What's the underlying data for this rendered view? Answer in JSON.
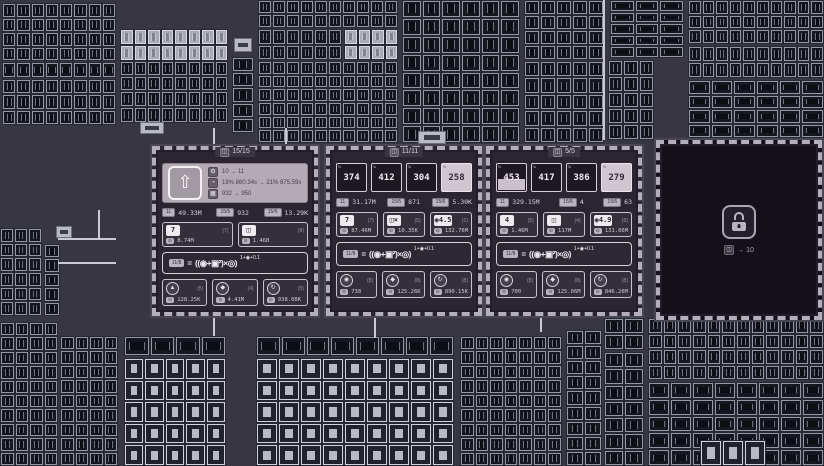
{
  "panels": [
    {
      "name": "upgrade-station",
      "header_icon": "◫",
      "header": "15/15",
      "card": {
        "arrow": "⇧",
        "rows": [
          {
            "icon": "⚙",
            "text": "10 → 11"
          },
          {
            "icon": "◔",
            "text": "19% 860.34s → 21% 875.59s"
          },
          {
            "icon": "▦",
            "text": "932 → 950"
          }
        ]
      },
      "stats": [
        {
          "badge": "11",
          "value": "49.33M"
        },
        {
          "badge": "15/5",
          "value": "932"
        },
        {
          "badge": "15/6",
          "value": "13.29K"
        }
      ],
      "slots": [
        {
          "tile": "7",
          "count": "(7)",
          "cost_icon": "⊙",
          "cost": "8.74M"
        },
        {
          "tile": "◫",
          "count": "(8)",
          "cost_icon": "⊙",
          "cost": "1.46B"
        }
      ],
      "formula": {
        "lhs": "11/8",
        "eq": "=",
        "body": "((◉+▣²)×◎)",
        "exp": "1+◉+0.1"
      },
      "actions": [
        {
          "glyph": "▲",
          "count": "(5)",
          "cost_icon": "⊙",
          "value": "128.25K"
        },
        {
          "glyph": "◆",
          "count": "(4)",
          "cost_icon": "⊙",
          "value": "4.41M"
        },
        {
          "glyph": "↻",
          "count": "(5)",
          "cost_icon": "⊙",
          "value": "938.08K"
        }
      ]
    },
    {
      "name": "station-2",
      "header_icon": "◫",
      "header": "11/11",
      "tiles": [
        {
          "corner": "↻",
          "value": "374"
        },
        {
          "corner": "↻",
          "value": "412"
        },
        {
          "corner": "↻",
          "value": "304"
        },
        {
          "corner": "↻",
          "value": "258"
        }
      ],
      "stats": [
        {
          "badge": "11",
          "value": "31.17M"
        },
        {
          "badge": "15/5",
          "value": "871"
        },
        {
          "badge": "15/6",
          "value": "5.30K"
        }
      ],
      "slots": [
        {
          "tile": "7",
          "count": "(7)",
          "cost_icon": "⊙",
          "cost": "87.46M"
        },
        {
          "tile": "◫×",
          "count": "(5)",
          "cost_icon": "⊙",
          "cost": "10.35K"
        },
        {
          "tile": "◉4.5",
          "count": "(1)",
          "cost_icon": "⊙",
          "cost": "132.76M"
        }
      ],
      "formula": {
        "lhs": "11/8",
        "eq": "=",
        "body": "((◉+▣²)×◎)",
        "exp": "1+◉+0.1"
      },
      "actions": [
        {
          "glyph": "◉",
          "count": "(8)",
          "cost_icon": "⊙",
          "value": "738"
        },
        {
          "glyph": "◆",
          "count": "(8)",
          "cost_icon": "⊙",
          "value": "125.26K"
        },
        {
          "glyph": "↻",
          "count": "(8)",
          "cost_icon": "⊙",
          "value": "890.15K"
        }
      ]
    },
    {
      "name": "station-3",
      "header_icon": "◫",
      "header": "5/5",
      "tiles": [
        {
          "corner": "↻",
          "value": "453"
        },
        {
          "corner": "↻",
          "value": "417"
        },
        {
          "corner": "↻",
          "value": "386"
        },
        {
          "corner": "↻",
          "value": "279"
        }
      ],
      "stats": [
        {
          "badge": "11",
          "value": "329.15M"
        },
        {
          "badge": "15/5",
          "value": "4"
        },
        {
          "badge": "15/6",
          "value": "63"
        }
      ],
      "slots": [
        {
          "tile": "4",
          "count": "(5)",
          "cost_icon": "⊙",
          "cost": "1.46M"
        },
        {
          "tile": "◫",
          "count": "(4)",
          "cost_icon": "⊙",
          "cost": "117M"
        },
        {
          "tile": "◉4.9",
          "count": "(5)",
          "cost_icon": "⊙",
          "cost": "131.06M"
        }
      ],
      "formula": {
        "lhs": "11/8",
        "eq": "=",
        "body": "((◉+▣²)×◎)",
        "exp": "1+◉+0.1"
      },
      "actions": [
        {
          "glyph": "◉",
          "count": "(8)",
          "cost_icon": "⊙",
          "value": "700"
        },
        {
          "glyph": "◆",
          "count": "(8)",
          "cost_icon": "⊙",
          "value": "125.06M"
        },
        {
          "glyph": "↻",
          "count": "(8)",
          "cost_icon": "⊙",
          "value": "846.26M"
        }
      ]
    },
    {
      "name": "locked-station",
      "caption_badge": "◫",
      "caption": "→ 10"
    }
  ]
}
